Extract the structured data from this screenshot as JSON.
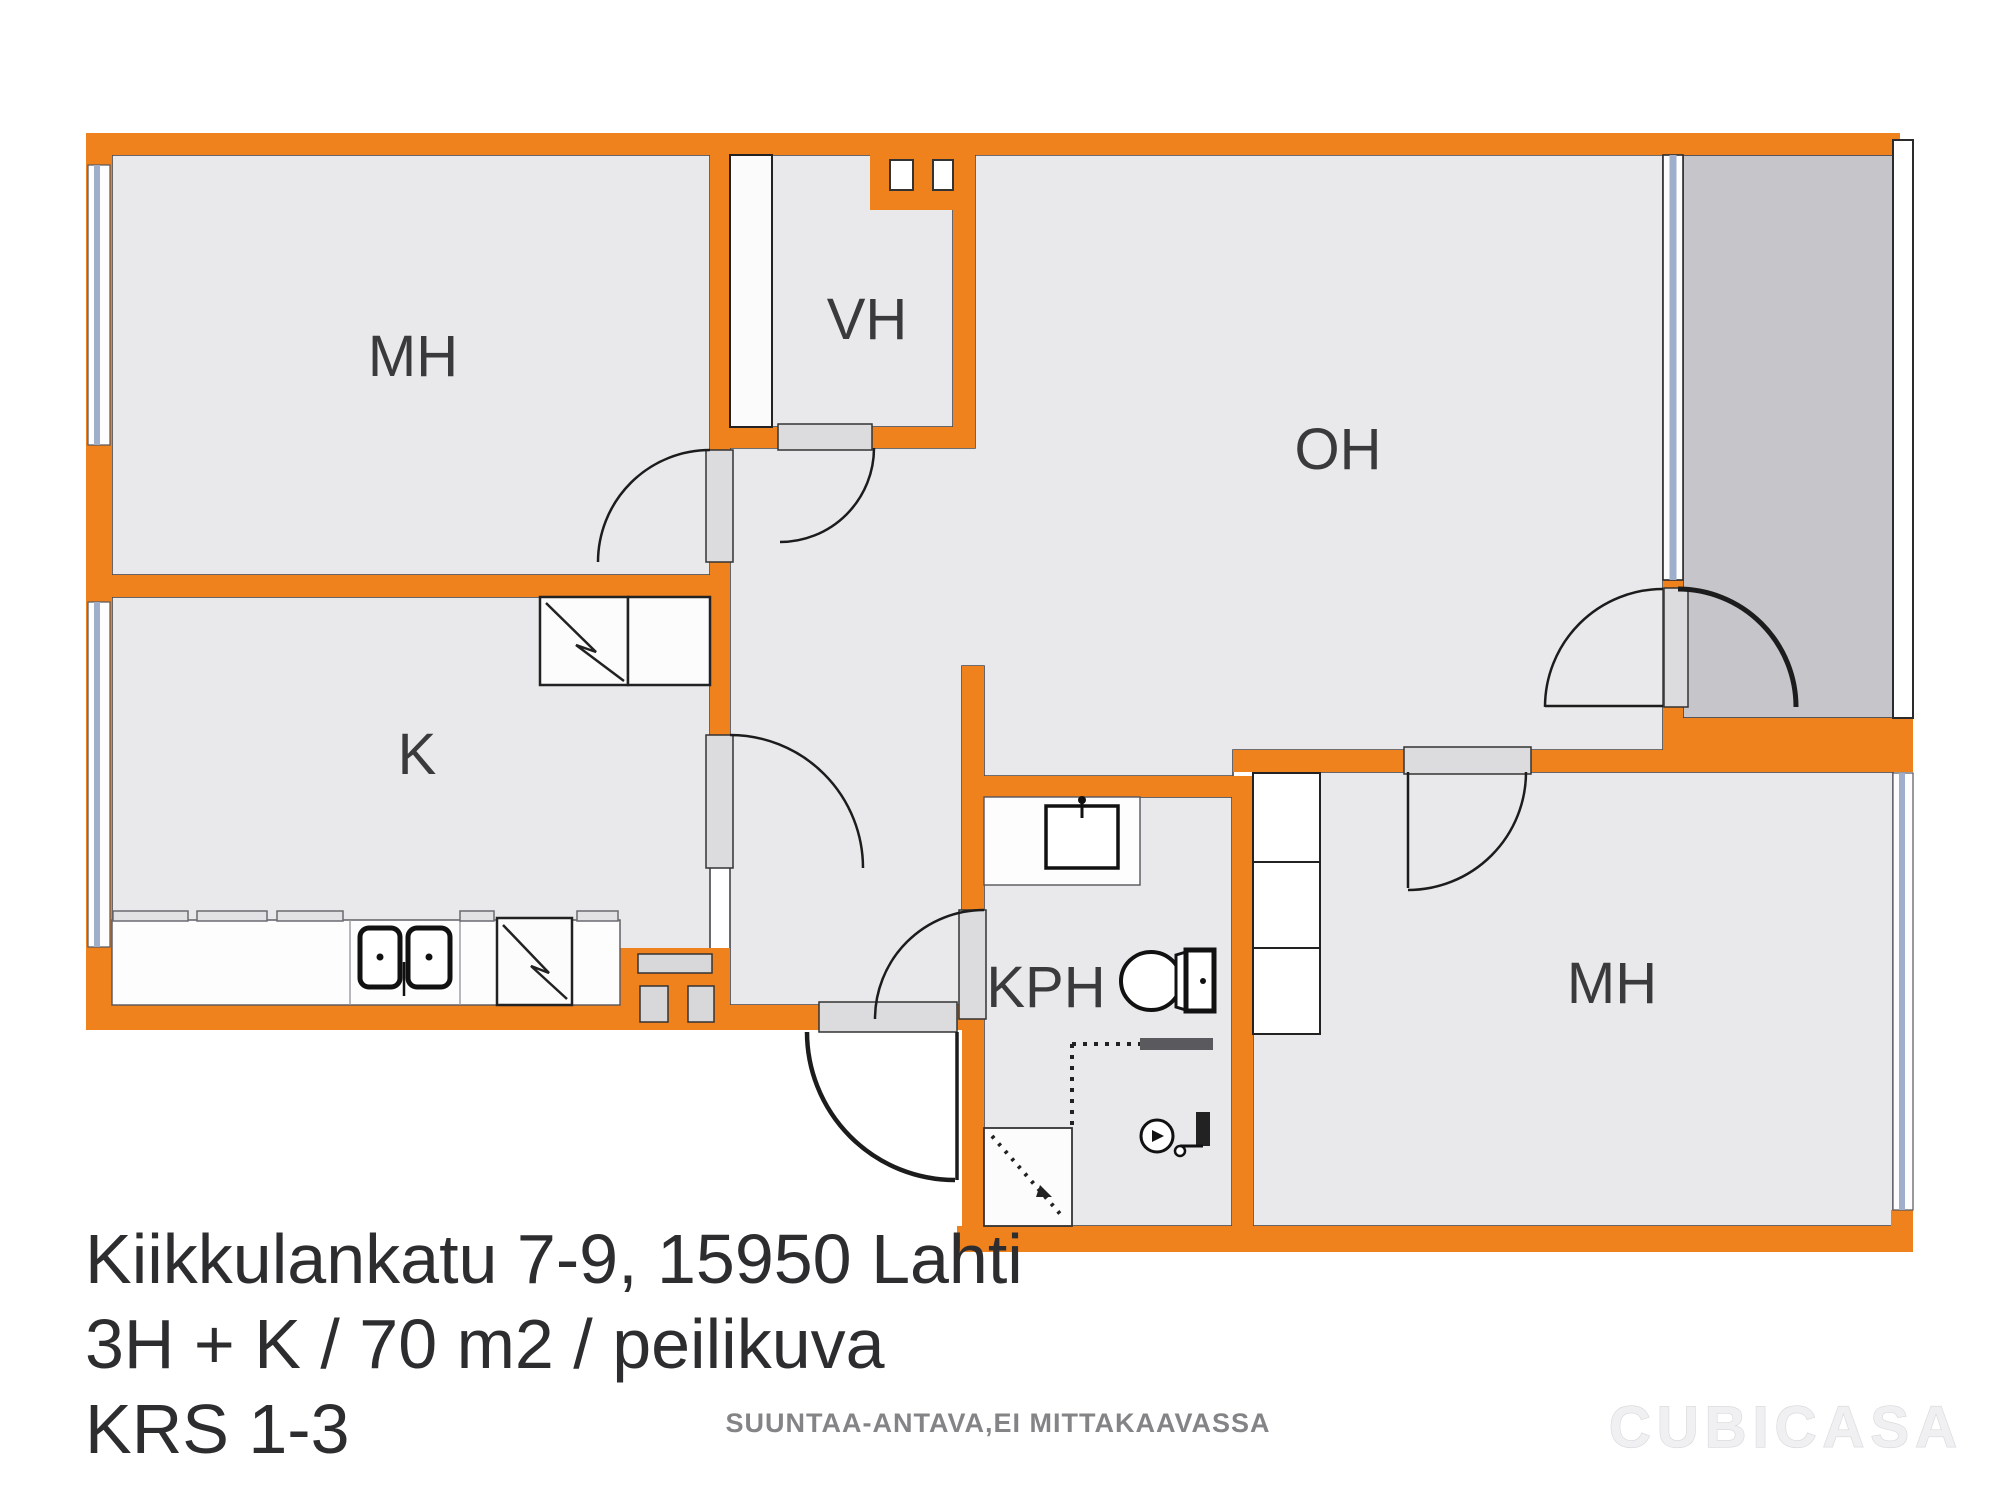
{
  "floor_plan": {
    "rooms": [
      {
        "id": "bedroom-1",
        "label": "MH"
      },
      {
        "id": "closet-hall",
        "label": "VH"
      },
      {
        "id": "living-room",
        "label": "OH"
      },
      {
        "id": "kitchen",
        "label": "K"
      },
      {
        "id": "bathroom",
        "label": "KPH"
      },
      {
        "id": "bedroom-2",
        "label": "MH"
      }
    ],
    "address": {
      "line1": "Kiikkulankatu 7-9, 15950 Lahti",
      "line2": "3H + K / 70 m2 / peilikuva",
      "line3": "KRS 1-3"
    },
    "footer": {
      "disclaimer": "SUUNTAA-ANTAVA,EI MITTAKAAVASSA",
      "brand": "CUBICASA"
    },
    "colors": {
      "wall": "#F0821E",
      "floor": "#E9E8EA",
      "balcony": "#C6C6CA",
      "door_threshold": "#DCDCDE",
      "window_glass": "#9FAECB",
      "label_text": "#3A3A3C",
      "address_text": "#2D2D2F",
      "disclaimer_text": "#848487"
    }
  }
}
